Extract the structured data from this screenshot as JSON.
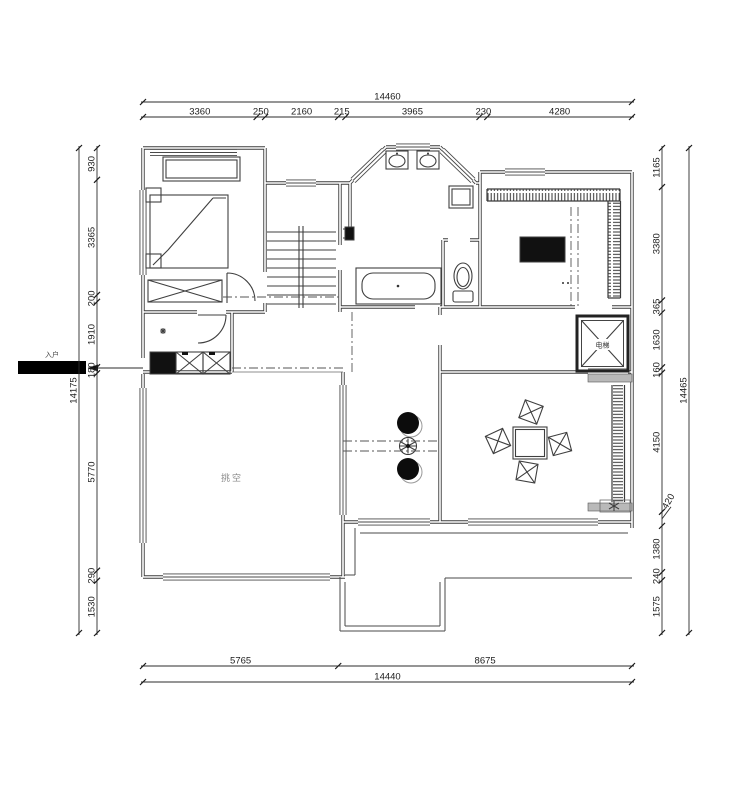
{
  "labels": {
    "entry": "入户",
    "void_space": "挑空",
    "elevator": "电梯"
  },
  "dimensions": {
    "top": {
      "total": "14460",
      "segments": [
        "3360",
        "250",
        "2160",
        "215",
        "3965",
        "230",
        "4280"
      ]
    },
    "bottom": {
      "total": "14440",
      "segments": [
        "5765",
        "8675"
      ]
    },
    "left": {
      "total": "14175",
      "segments": [
        "930",
        "3365",
        "200",
        "1910",
        "180",
        "5770",
        "290",
        "1530"
      ]
    },
    "right": {
      "total": "14465",
      "segments": [
        "1165",
        "3380",
        "365",
        "1630",
        "160",
        "4150",
        "420",
        "1380",
        "240",
        "1575"
      ]
    }
  },
  "colors": {
    "wall_line": "#3d3d3d",
    "dim_text": "#1d1d1d",
    "room_label": "#8a8a8a",
    "background": "#ffffff"
  }
}
